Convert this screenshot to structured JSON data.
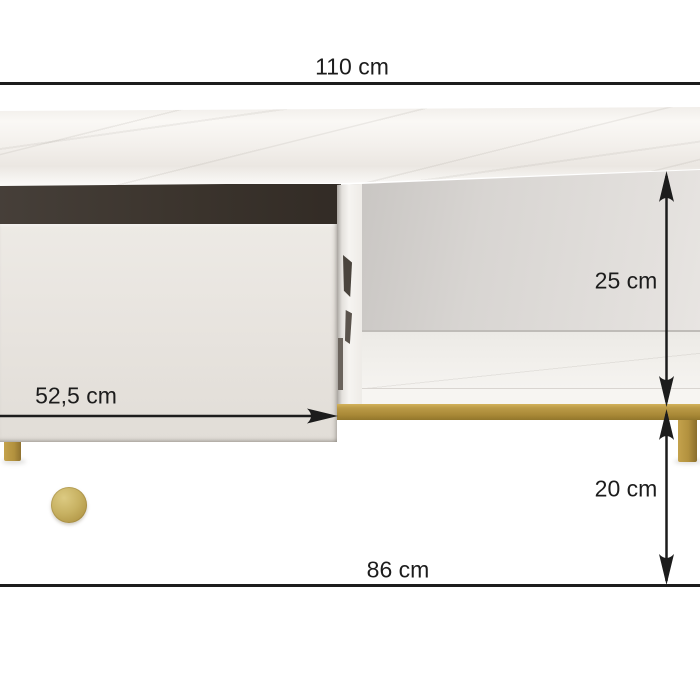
{
  "diagram": {
    "subject": "tv-stand-with-marble-top-open-drawer-and-gold-legs",
    "dimensions": {
      "top_width": "110 cm",
      "shelf_height": "25 cm",
      "drawer_width": "52,5 cm",
      "leg_height": "20 cm",
      "bottom_width": "86 cm"
    }
  },
  "colors": {
    "line": "#1c1c1c",
    "text": "#1c1c1c",
    "gold": "#b2913e",
    "gold-light": "#cfae58",
    "gold-dark": "#8a6e2c",
    "drawer": "#e8e4df",
    "marble": "#f4f1ed",
    "cavity": "#3b342d",
    "interior": "#d9d6d3",
    "floor": "#ffffff"
  }
}
